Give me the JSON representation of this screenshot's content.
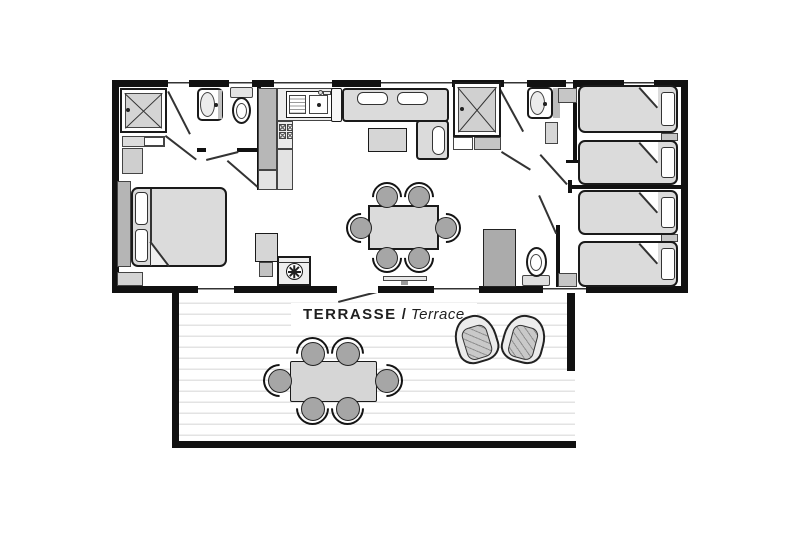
{
  "terrace_label": {
    "fr": "TERRASSE",
    "separator": "/",
    "en": "Terrace"
  },
  "colors": {
    "wall": "#111111",
    "outline": "#1a1a1a",
    "furniture_fill": "#dbdbdb",
    "furniture_mid": "#b7b7b7",
    "chair_fill": "#a6a6a6",
    "deck_line": "#e3e3e3",
    "label_text": "#1f1f1f",
    "background": "#ffffff"
  },
  "icons": [
    "shower-icon",
    "washbasin-icon",
    "toilet-icon",
    "double-bed-icon",
    "single-bed-icon",
    "kitchen-sink-icon",
    "stove-icon",
    "washing-machine-icon",
    "fridge-icon",
    "sofa-icon",
    "coffee-table-icon",
    "dining-table-icon",
    "dining-chair-icon",
    "wardrobe-icon",
    "sideboard-icon",
    "outdoor-armchair-icon",
    "outdoor-table-icon",
    "outdoor-chair-icon",
    "window-icon",
    "door-swing-icon"
  ]
}
